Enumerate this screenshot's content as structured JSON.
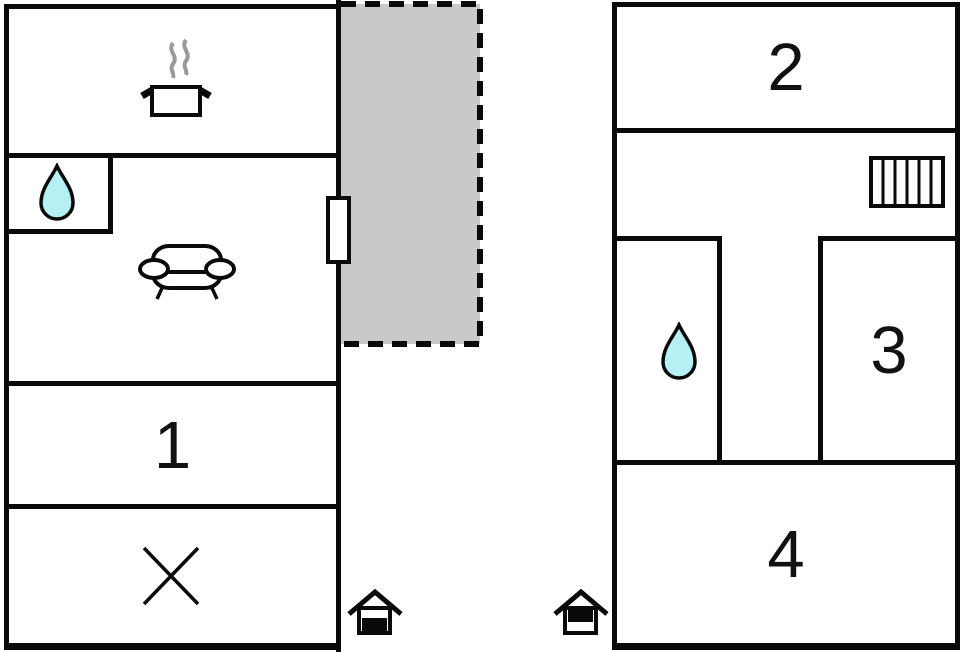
{
  "colors": {
    "wall": "#0a0a0a",
    "terrace_fill": "#c9c9c9",
    "water_drop_fill": "#b4f0f4",
    "steam": "#9a9a9a",
    "background": "#ffffff"
  },
  "left_plan": {
    "rooms": [
      {
        "id": "kitchen",
        "icon": "cooking-pot-icon"
      },
      {
        "id": "bathroom",
        "icon": "water-drop-icon"
      },
      {
        "id": "living-room",
        "icon": "sofa-icon"
      },
      {
        "id": "room-1",
        "label": "1"
      },
      {
        "id": "storage",
        "icon": "cross-icon"
      }
    ],
    "terrace": {
      "style": "dashed-outline",
      "fill": "#c9c9c9"
    },
    "door": {
      "position": "right-wall"
    }
  },
  "right_plan": {
    "rooms": [
      {
        "id": "room-2",
        "label": "2"
      },
      {
        "id": "hallway",
        "icon": "radiator-icon"
      },
      {
        "id": "bathroom",
        "icon": "water-drop-icon"
      },
      {
        "id": "room-3",
        "label": "3"
      },
      {
        "id": "room-4",
        "label": "4"
      }
    ]
  },
  "floor_indicators": [
    {
      "id": "ground-floor",
      "icon": "house-ground-floor-icon",
      "filled": "bottom"
    },
    {
      "id": "upper-floor",
      "icon": "house-upper-floor-icon",
      "filled": "top"
    }
  ]
}
